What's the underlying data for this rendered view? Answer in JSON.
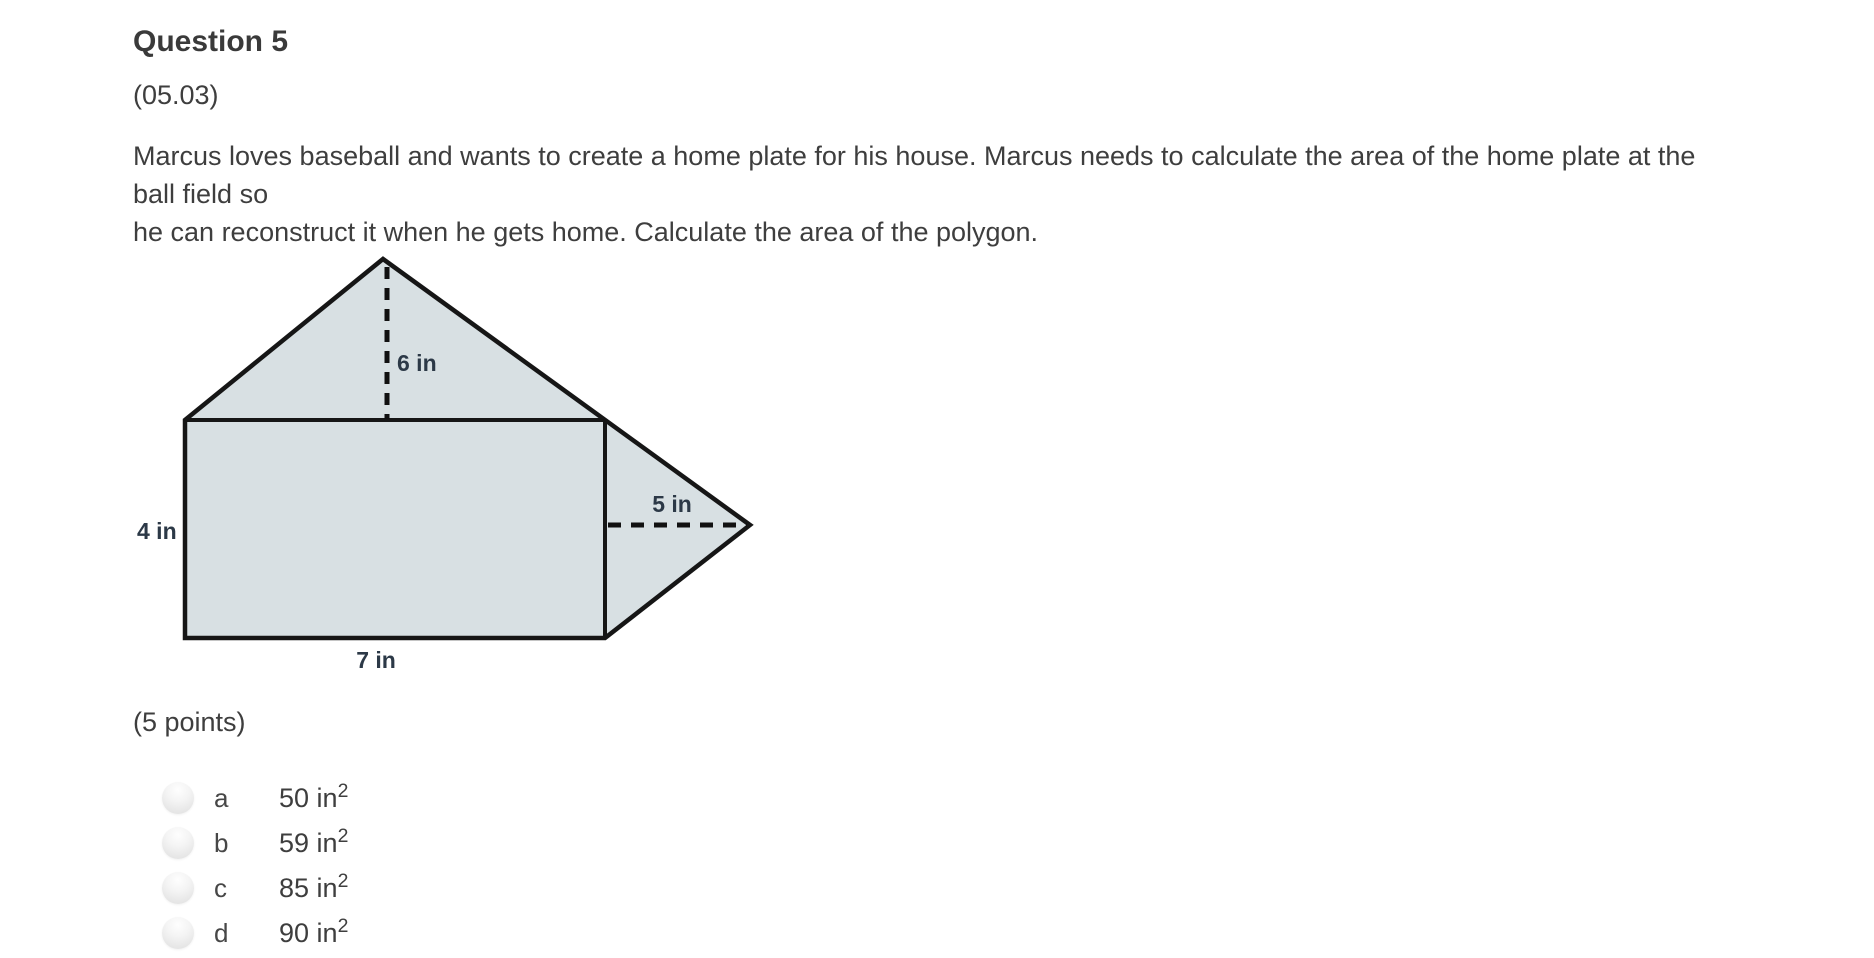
{
  "question": {
    "title": "Question 5",
    "code": "(05.03)",
    "prompt_lines": [
      "Marcus loves baseball and wants to create a home plate for his house. Marcus needs to calculate the area of the home plate at the ball field so",
      "he can reconstruct it when he gets home. Calculate the area of the polygon."
    ],
    "points_label": "(5 points)"
  },
  "figure": {
    "height_label": "6 in",
    "side_label": "4 in",
    "right_label": "5 in",
    "base_label": "7 in",
    "fill_color": "#d8e0e3",
    "stroke_color": "#161616",
    "label_color": "#2c3947"
  },
  "options": [
    {
      "letter": "a",
      "text": "50 in",
      "sup": "2"
    },
    {
      "letter": "b",
      "text": "59 in",
      "sup": "2"
    },
    {
      "letter": "c",
      "text": "85 in",
      "sup": "2"
    },
    {
      "letter": "d",
      "text": "90 in",
      "sup": "2"
    }
  ]
}
